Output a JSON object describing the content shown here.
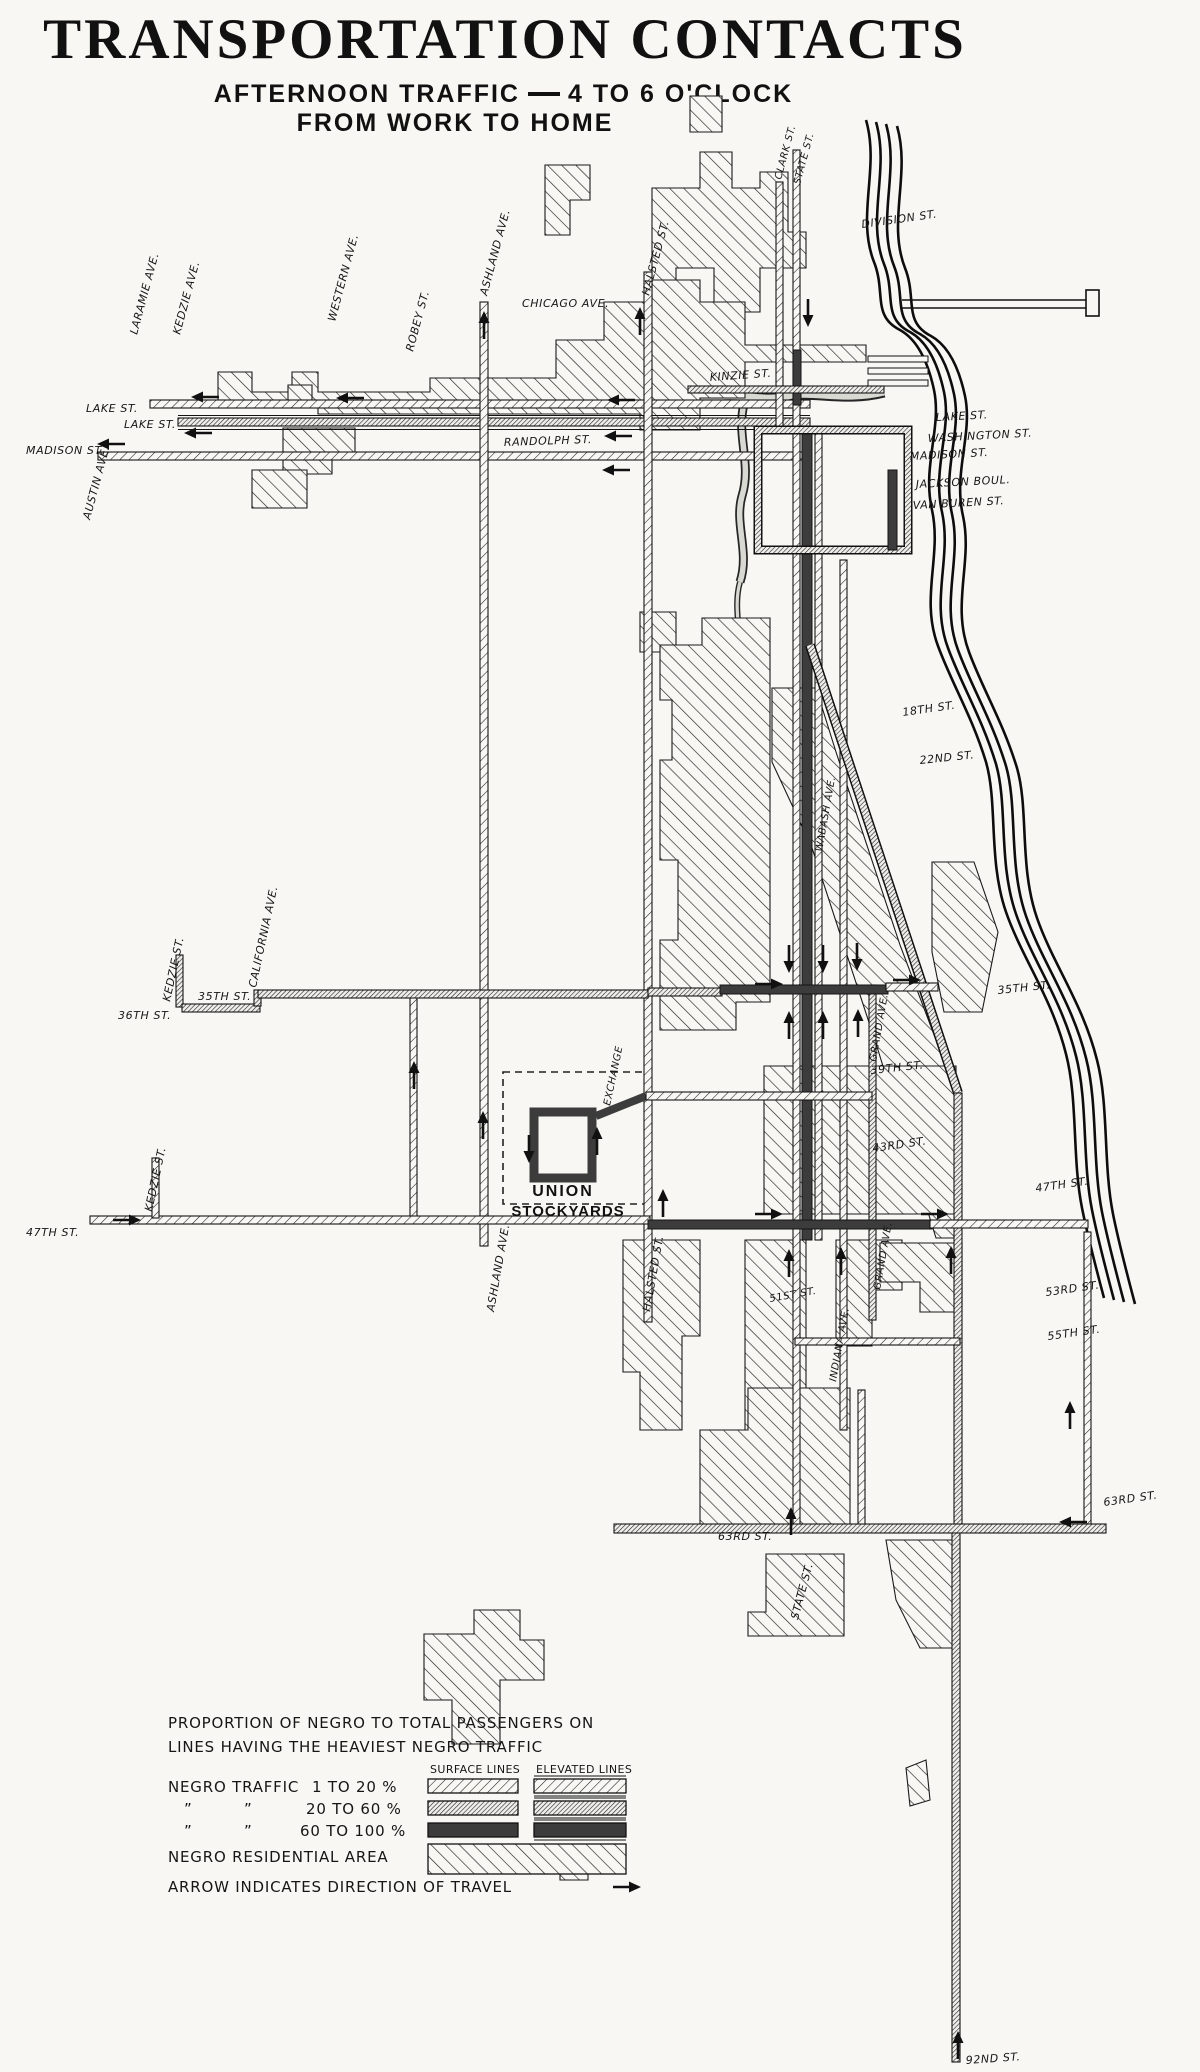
{
  "title": {
    "main": "TRANSPORTATION CONTACTS",
    "subtitle_left": "AFTERNOON TRAFFIC",
    "subtitle_right": "4 TO 6 O'CLOCK",
    "subtitle2": "FROM WORK TO HOME"
  },
  "legend": {
    "heading1": "PROPORTION OF NEGRO TO TOTAL PASSENGERS ON",
    "heading2": "LINES HAVING THE HEAVIEST NEGRO TRAFFIC",
    "col_surface": "SURFACE LINES",
    "col_elevated": "ELEVATED LINES",
    "traffic_label": "NEGRO TRAFFIC",
    "ditto": "”",
    "range1": "1 TO 20 %",
    "range2": "20 TO 60 %",
    "range3": "60 TO 100 %",
    "residential_label": "NEGRO RESIDENTIAL AREA",
    "arrow_note": "ARROW INDICATES DIRECTION OF TRAVEL"
  },
  "map": {
    "labels": {
      "austin_ave": "AUSTIN AVE.",
      "laramie_ave": "LARAMIE AVE.",
      "kedzie_ave": "KEDZIE AVE.",
      "western_ave": "WESTERN AVE.",
      "robey_st": "ROBEY ST.",
      "ashland_n": "ASHLAND AVE.",
      "halsted_n": "HALSTED ST.",
      "chicago_ave": "CHICAGO AVE.",
      "clark_st": "CLARK ST.",
      "state_n": "STATE ST.",
      "division": "DIVISION ST.",
      "kinzie": "KINZIE ST.",
      "lake_w1": "LAKE ST.",
      "lake_w2": "LAKE ST.",
      "madison_w": "MADISON ST.",
      "randolph": "RANDOLPH ST.",
      "lake_e": "LAKE ST.",
      "washington": "WASHINGTON ST.",
      "madison_e": "MADISON ST.",
      "jackson": "JACKSON BOUL.",
      "vanburen": "VAN BUREN ST.",
      "s18": "18TH ST.",
      "s22": "22ND ST.",
      "s35e": "35TH ST.",
      "grand1": "GRAND AVE.",
      "s39": "39TH ST.",
      "s43": "43RD ST.",
      "s47e": "47TH ST.",
      "s53": "53RD ST.",
      "s55e": "55TH ST.",
      "s63e": "63RD ST.",
      "kedzie1": "KEDZIE ST.",
      "california": "CALIFORNIA AVE.",
      "s35w": "35TH ST.",
      "s36w": "36TH ST.",
      "kedzie2": "KEDZIE ST.",
      "s47w": "47TH ST.",
      "exchange": "EXCHANGE",
      "union": "UNION",
      "stockyards": "STOCKYARDS",
      "ashland_s": "ASHLAND AVE.",
      "halsted_s": "HALSTED ST.",
      "wabash": "WABASH AVE.",
      "s51": "51ST ST.",
      "indiana": "INDIANA AVE.",
      "grand2": "GRAND AVE.",
      "s63w": "63RD ST.",
      "state_s": "STATE ST.",
      "s92": "92ND ST."
    }
  }
}
